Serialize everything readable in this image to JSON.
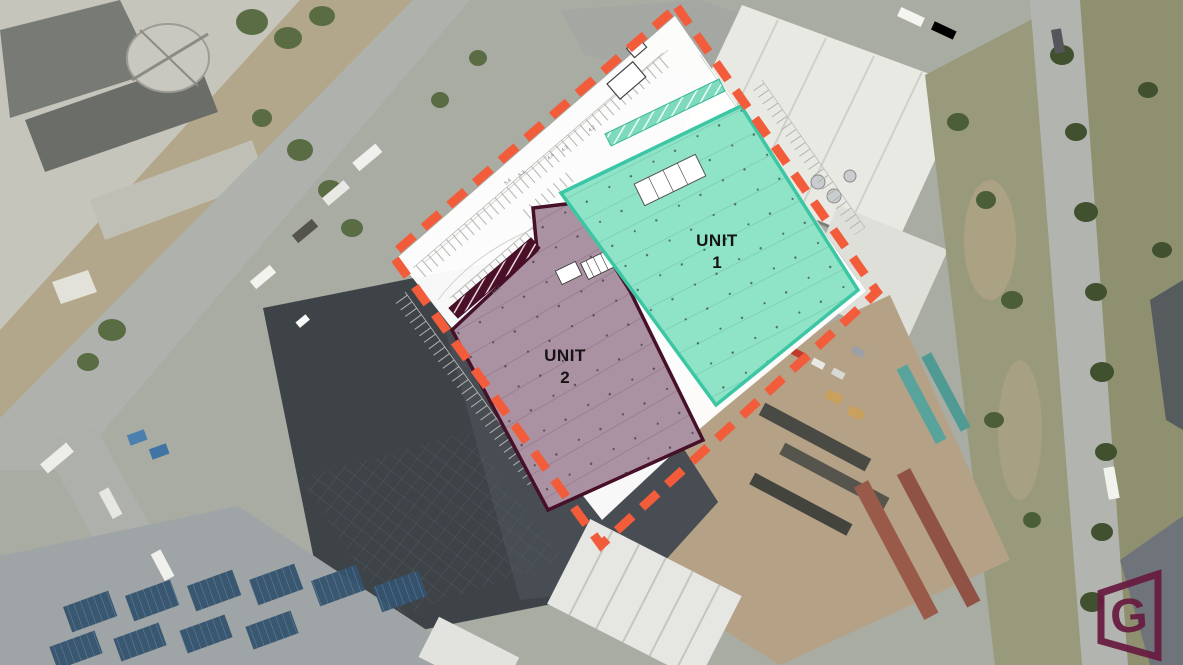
{
  "site_plan": {
    "plan_fill": "#FFFFFF",
    "boundary": {
      "color": "#F25C3B"
    },
    "label_color": "#141414",
    "units": [
      {
        "name": "UNIT 1",
        "label": "UNIT",
        "number": "1",
        "fill": "#8FE4C8",
        "outline": "#3CC6A4"
      },
      {
        "name": "UNIT 2",
        "label": "UNIT",
        "number": "2",
        "fill": "#AB92A2",
        "outline": "#451028"
      }
    ],
    "annotations": [
      "5.4",
      "5.3",
      "4.4",
      "4.3",
      "4.2",
      "50.4"
    ]
  },
  "branding": {
    "logo_letter": "G",
    "logo_color": "#681B40"
  }
}
